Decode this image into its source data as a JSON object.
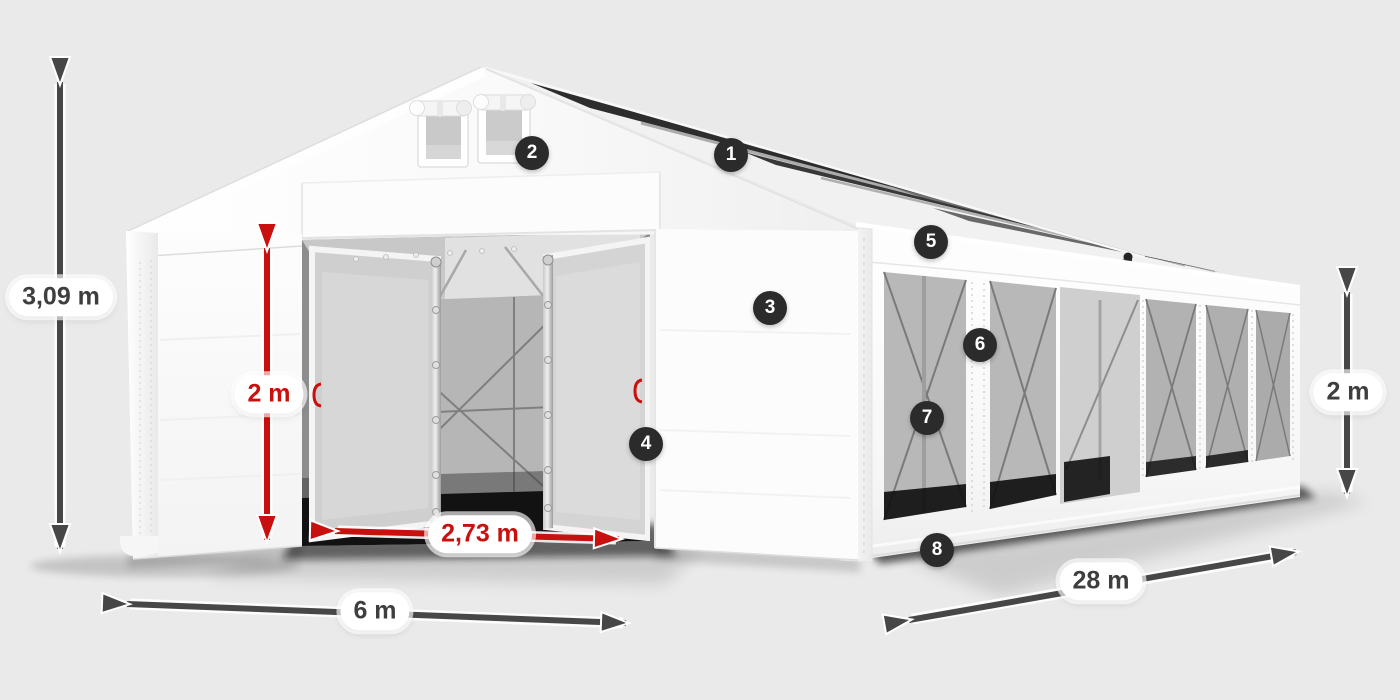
{
  "scene": {
    "background_color": "#eaeaea",
    "subject": "white storage tent illustration with dimension arrows and numbered feature callouts"
  },
  "colors": {
    "canvas_background": "#eaeaea",
    "arrow_dark": "#474747",
    "accent_red": "#c8100e",
    "label_text_dark": "#3e3e3e",
    "pill_background": "#ffffff",
    "badge_background": "#2b2b2b",
    "badge_text": "#ffffff",
    "tent_white": "#fbfbfb",
    "window_gray": "#b5b5b5",
    "roof_panel_dark": "#2e2e2e"
  },
  "dimensions": {
    "total_height": {
      "label": "3,09 m",
      "color": "#3e3e3e"
    },
    "entrance_height": {
      "label": "2 m",
      "color": "#c8100e"
    },
    "entrance_width": {
      "label": "2,73 m",
      "color": "#c8100e"
    },
    "tent_width": {
      "label": "6 m",
      "color": "#3e3e3e"
    },
    "tent_length": {
      "label": "28 m",
      "color": "#3e3e3e"
    },
    "side_wall_height": {
      "label": "2 m",
      "color": "#3e3e3e"
    }
  },
  "callouts": {
    "badge_background": "#2b2b2b",
    "badge_text_color": "#ffffff",
    "items": [
      {
        "number": "1"
      },
      {
        "number": "2"
      },
      {
        "number": "3"
      },
      {
        "number": "4"
      },
      {
        "number": "5"
      },
      {
        "number": "6"
      },
      {
        "number": "7"
      },
      {
        "number": "8"
      }
    ]
  }
}
